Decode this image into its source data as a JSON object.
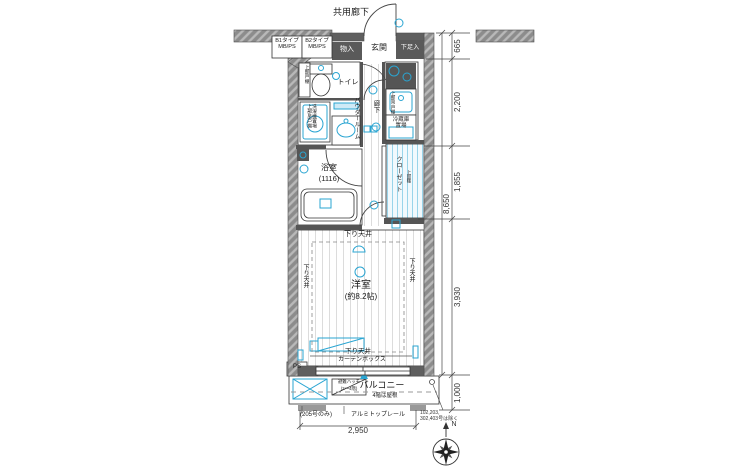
{
  "labels": {
    "corridor": "共用廊下",
    "meter_box_b1": "B1タイプ\nMB/PS",
    "meter_box_b2": "B2タイプ\nMB/PS",
    "storage": "物入",
    "entrance": "玄関",
    "shoe_cabinet": "下足入",
    "toilet": "トイレ",
    "toilet_shelf": "上部戸棚",
    "laundry": "洗濯機置場\n上部吊戸棚",
    "powder_room": "パウダールーム",
    "hallway": "廊下",
    "kitchen_shelf": "上部吊戸棚",
    "fridge_space": "冷蔵庫\n置場",
    "bathroom": "浴室",
    "bathroom_module": "(1116)",
    "closet": "クローゼット",
    "closet_shelf": "上部棚",
    "lowered_ceiling": "下り天井",
    "curtain_box": "カーテンボックス",
    "main_room": "洋室",
    "main_room_size": "(約8.2帖)",
    "pipe_space": "PS",
    "balcony": "バルコニー",
    "balcony_note": "4階は屋根",
    "escape_hatch": "避難ハッチ",
    "escape_hatch_floors": "(2〜4階)",
    "only_205": "(205号のみ)",
    "top_rail": "アルミトップレール",
    "excluded_rooms": "102,203,\n302,403号は除く",
    "compass_north": "N"
  },
  "dimensions": {
    "d665": "665",
    "d2200": "2,200",
    "d1855": "1,855",
    "d3930": "3,930",
    "d8650": "8,650",
    "d1000": "1,000",
    "d2950": "2,950"
  },
  "colors": {
    "accent": "#2aa5d2",
    "wall_dark": "#5f5f5f",
    "wall_hatch": "#8c8c8c",
    "line": "#333333"
  }
}
